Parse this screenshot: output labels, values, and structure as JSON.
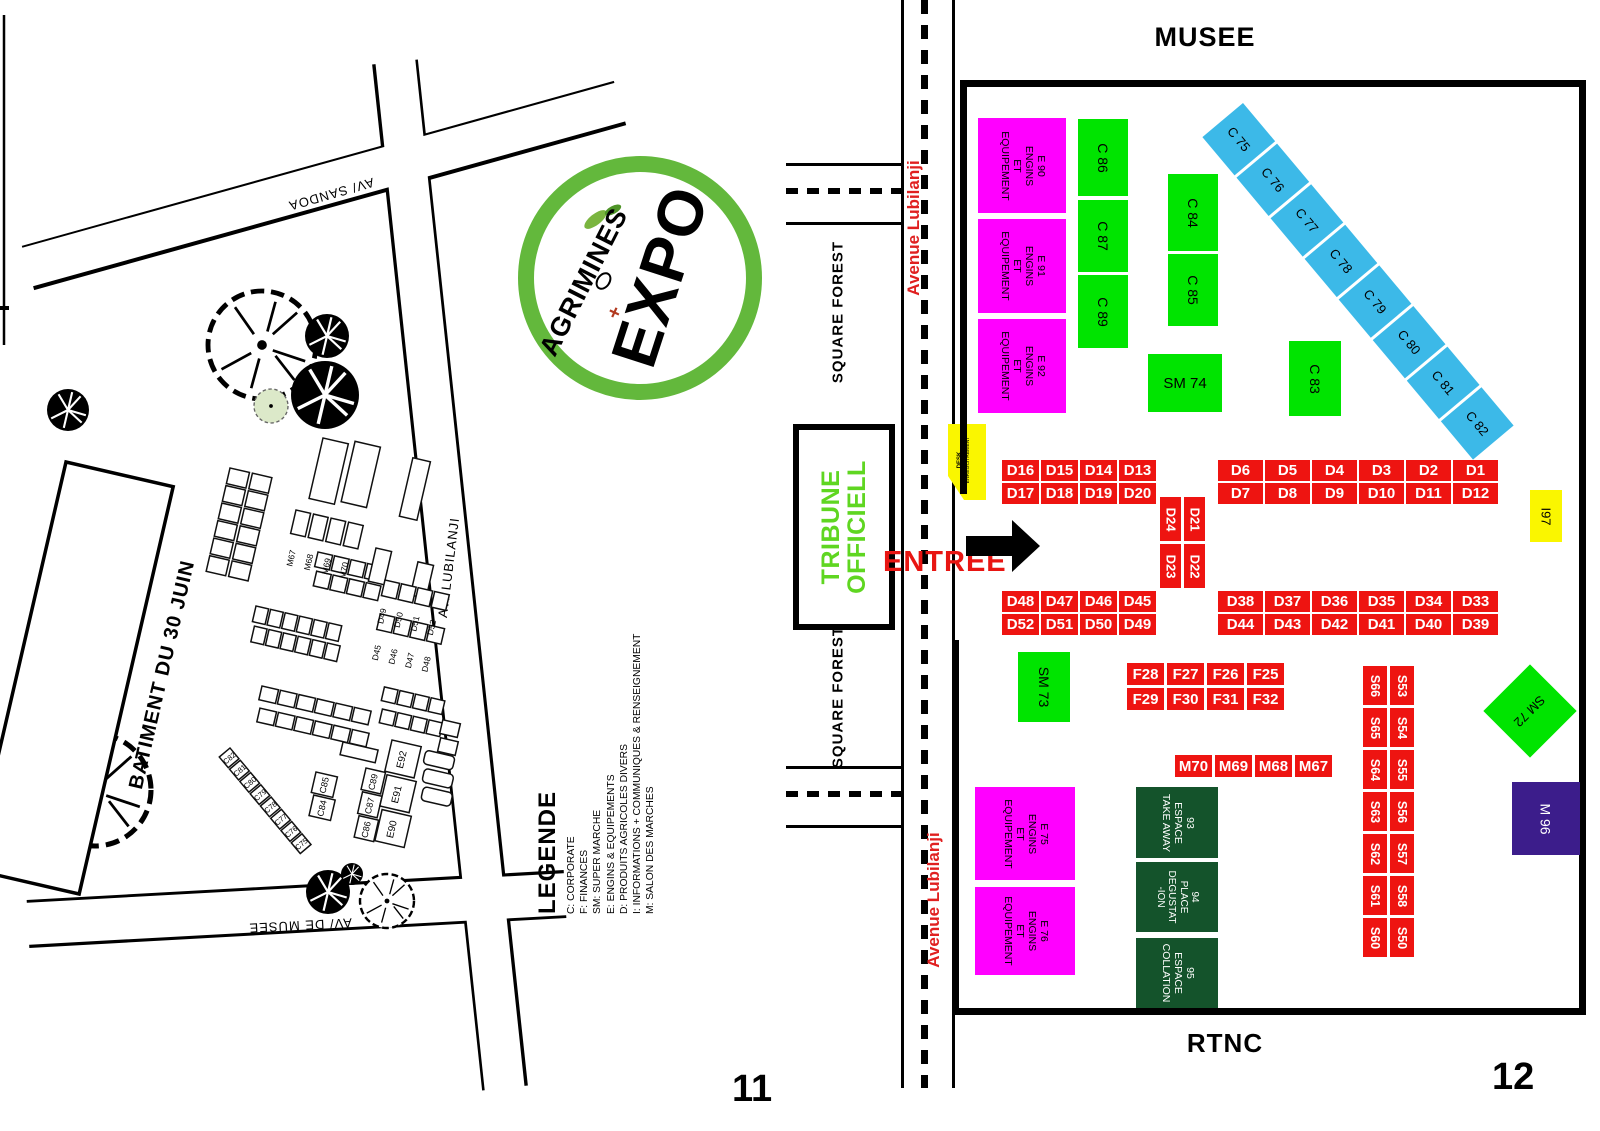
{
  "colors": {
    "magenta": "#FF00FF",
    "booth_green": "#00E400",
    "cyan": "#3CB9E8",
    "red": "#EE1411",
    "yellow": "#FAF600",
    "dark_green": "#14532B",
    "purple": "#3C1D8B",
    "tribune_green": "#5FD621",
    "logo_green": "#63B83C",
    "avenue_red": "#E02020",
    "entree_red": "#E81512"
  },
  "page_left": {
    "page_number": "11",
    "batiment": "BATIMENT DU 30 JUIN",
    "streets": {
      "sandoa": "AV/ SANDOA",
      "musee": "AV/ DE MUSEE",
      "lubilanji": "AV/ LUBILANJI"
    },
    "legend": {
      "title": "LEGENDE",
      "items": [
        "C: CORPORATE",
        "F: FINANCES",
        "SM: SUPER MARCHE",
        "E: ENGINS & EQUIPEMENTS",
        "D: PRODUITS AGRICOLES DIVERS",
        "I: INFORMATIONS + COMMUNIQUES & RENSEIGNEMENT",
        "M: SALON DES MARCHES"
      ]
    },
    "logo": {
      "brand": "AGRIMINES",
      "word": "EXPO"
    },
    "labels": {
      "m_row": [
        "M67",
        "M68",
        "M69",
        "M70"
      ],
      "d_top": [
        "D49",
        "D50",
        "D51",
        "D52"
      ],
      "d_bottom": [
        "D45",
        "D46",
        "D47",
        "D48"
      ],
      "c_pair": [
        "C85",
        "C84"
      ],
      "c_col": [
        "C89",
        "C87",
        "C86"
      ],
      "e_col": [
        "E92",
        "E91",
        "E90"
      ],
      "c_diag": [
        "C82",
        "C81",
        "C80",
        "C79",
        "C78",
        "C77",
        "C76",
        "C75"
      ]
    }
  },
  "page_right": {
    "page_number": "12",
    "musee": "MUSEE",
    "rtnc": "RTNC",
    "entree": "ENTREE",
    "avenue": "Avenue Lubilanji",
    "square_forest": "SQUARE FOREST",
    "tribune": [
      "TRIBUNE",
      "OFFICIELL"
    ],
    "desk": [
      "DESK",
      "ENREGISTREMENT"
    ],
    "magenta": [
      [
        "E 90",
        "ENGINS",
        "ET",
        "EQUIPEMENT"
      ],
      [
        "E 91",
        "ENGINS",
        "ET",
        "EQUIPEMENT"
      ],
      [
        "E 92",
        "ENGINS",
        "ET",
        "EQUIPEMENT"
      ],
      [
        "E 75",
        "ENGINS",
        "ET",
        "EQUIPEMENT"
      ],
      [
        "E 76",
        "ENGINS",
        "ET",
        "EQUIPEMENT"
      ]
    ],
    "green": {
      "c86": "C 86",
      "c87": "C 87",
      "c89": "C 89",
      "c84": "C 84",
      "c85": "C 85",
      "sm74": "SM 74",
      "c83": "C 83",
      "sm73": "SM 73",
      "sm72": "SM 72"
    },
    "cyan": [
      "C 75",
      "C 76",
      "C 77",
      "C 78",
      "C 79",
      "C 80",
      "C 81",
      "C 82"
    ],
    "d_nw": [
      "D16",
      "D15",
      "D14",
      "D13",
      "D17",
      "D18",
      "D19",
      "D20"
    ],
    "d_ne": [
      "D6",
      "D5",
      "D4",
      "D3",
      "D2",
      "D1",
      "D7",
      "D8",
      "D9",
      "D10",
      "D11",
      "D12"
    ],
    "d_center": [
      "D24",
      "D21",
      "D23",
      "D22"
    ],
    "d_sw": [
      "D48",
      "D47",
      "D46",
      "D45",
      "D52",
      "D51",
      "D50",
      "D49"
    ],
    "d_se": [
      "D38",
      "D37",
      "D36",
      "D35",
      "D34",
      "D33",
      "D44",
      "D43",
      "D42",
      "D41",
      "D40",
      "D39"
    ],
    "f_grid": [
      "F28",
      "F27",
      "F26",
      "F25",
      "F29",
      "F30",
      "F31",
      "F32"
    ],
    "m_row": [
      "M70",
      "M69",
      "M68",
      "M67"
    ],
    "s_left": [
      "S66",
      "S65",
      "S64",
      "S63",
      "S62",
      "S61",
      "S60"
    ],
    "s_right": [
      "S53",
      "S54",
      "S55",
      "S56",
      "S57",
      "S58",
      "S50"
    ],
    "i97": "I97",
    "m96": "M 96",
    "dark_green": [
      [
        "93",
        "ESPACE",
        "TAKE AWAY"
      ],
      [
        "94",
        "PLACE",
        "DEGUSTAT",
        "-ION"
      ],
      [
        "95",
        "ESPACE",
        "COLLATION"
      ]
    ]
  }
}
